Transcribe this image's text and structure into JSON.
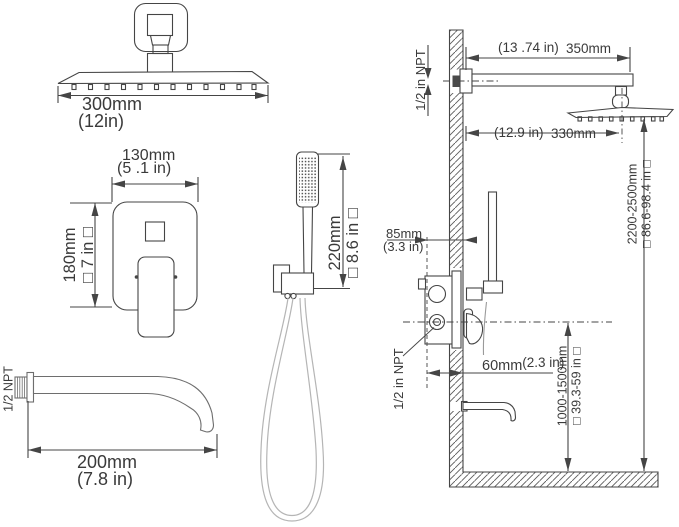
{
  "canvas": {
    "width": 679,
    "height": 527,
    "background": "#ffffff",
    "line_color": "#454545",
    "text_color": "#3a3a3a",
    "hose_color": "#b5b5b5"
  },
  "front_views": {
    "overhead_shower": {
      "width_mm": "300mm",
      "width_in": "(12in)"
    },
    "mixer_valve": {
      "width_mm": "130mm",
      "width_in": "(5 .1 in)",
      "height_mm": "180mm",
      "height_in": "□ 7 in □"
    },
    "hand_shower": {
      "height_mm": "220mm",
      "height_in": "□ 8.6 in □"
    },
    "tub_spout": {
      "thread": "1/2 NPT",
      "length_mm": "200mm",
      "length_in": "(7.8 in)"
    }
  },
  "side_view": {
    "arm_length_in": "(13 .74 in)",
    "arm_length_mm": "350mm",
    "arm_thread": "1/2 in NPT",
    "head_offset_in": "(12.9 in)",
    "head_offset_mm": "330mm",
    "head_height_mm": "2200-2500mm",
    "head_height_in": "□ 86.6-98.4 in □",
    "valve_depth_mm": "85mm",
    "valve_depth_in": "(3.3 in)",
    "spout_offset_mm": "60mm",
    "spout_offset_in": "(2.3 in)",
    "valve_thread": "1/2 in NPT",
    "valve_height_mm": "1000-1500mm",
    "valve_height_in": "□ 39.3-59 in □"
  }
}
